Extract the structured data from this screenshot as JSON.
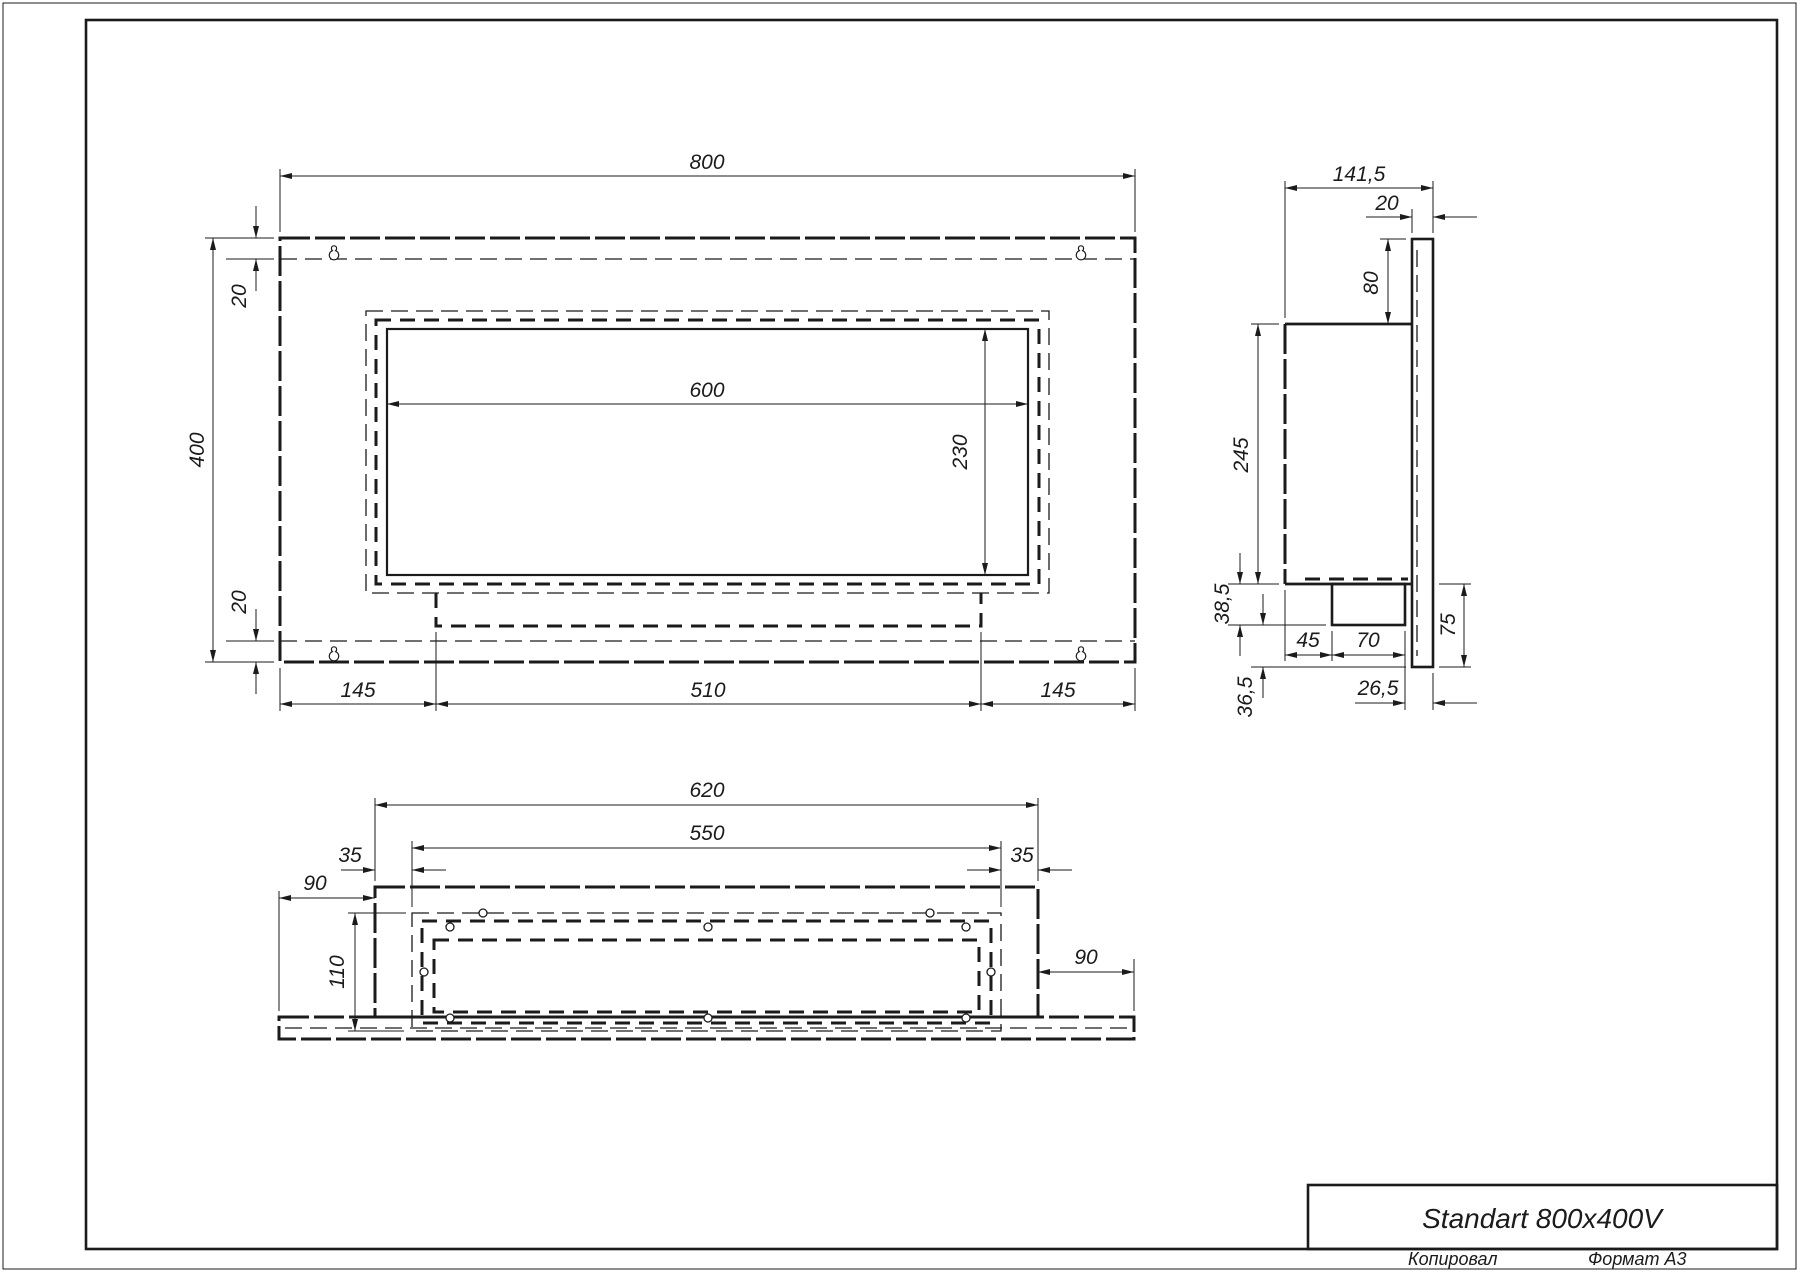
{
  "colors": {
    "line": "#1b1b1b",
    "background": "#ffffff"
  },
  "front_view": {
    "dim_width": "800",
    "dim_height": "400",
    "dim_opening_width": "600",
    "dim_opening_height": "230",
    "dim_top_margin": "20",
    "dim_bottom_margin": "20",
    "dim_bottom_left": "145",
    "dim_bottom_center": "510",
    "dim_bottom_right": "145"
  },
  "side_view": {
    "dim_depth": "141,5",
    "dim_plate_thickness": "20",
    "dim_top_offset": "80",
    "dim_body_height": "245",
    "dim_burner_drop": "38,5",
    "dim_bottom_gap": "36,5",
    "dim_bottom_total": "75",
    "dim_front_gap": "45",
    "dim_burner_width": "70",
    "dim_back_gap": "26,5"
  },
  "bottom_view": {
    "dim_box_width": "620",
    "dim_opening_width": "550",
    "dim_left_inset": "35",
    "dim_right_inset": "35",
    "dim_left_flange": "90",
    "dim_right_flange": "90",
    "dim_depth": "110"
  },
  "title_block": {
    "title": "Standart 800x400V"
  },
  "footer": {
    "copied_label": "Копировал",
    "format_label": "Формат А3"
  }
}
